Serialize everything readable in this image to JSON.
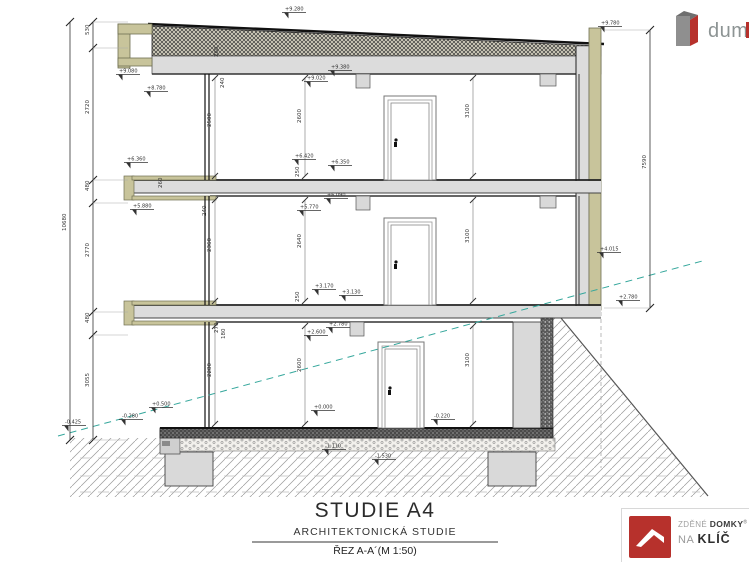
{
  "top_logo": {
    "text": "dum"
  },
  "title_block": {
    "title": "STUDIE A4",
    "subtitle": "ARCHITEKTONICKÁ STUDIE",
    "sheet": "ŘEZ A-A´(M 1:50)"
  },
  "brand": {
    "word1": "ZDĚNÉ",
    "word2": "DOMKY",
    "reg": "®",
    "word3": "NA",
    "word4": "KLÍČ"
  },
  "colors": {
    "olive_insulation": "#c8c49b",
    "slab_gray": "#dcdcdc",
    "terrain_teal": "#35a79c",
    "brand_red": "#b7312c",
    "dim_text": "#333333"
  },
  "drawing": {
    "dims": [
      {
        "t": "530",
        "x": 89,
        "y": 35,
        "r": true
      },
      {
        "t": "2720",
        "x": 89,
        "y": 114,
        "r": true
      },
      {
        "t": "480",
        "x": 89,
        "y": 191,
        "r": true
      },
      {
        "t": "2770",
        "x": 89,
        "y": 257,
        "r": true
      },
      {
        "t": "480",
        "x": 89,
        "y": 323,
        "r": true
      },
      {
        "t": "3055",
        "x": 89,
        "y": 387,
        "r": true
      },
      {
        "t": "10680",
        "x": 66,
        "y": 231,
        "r": true
      },
      {
        "t": "7590",
        "x": 646,
        "y": 169,
        "r": true
      },
      {
        "t": "2500",
        "x": 211,
        "y": 127,
        "r": true
      },
      {
        "t": "2600",
        "x": 301,
        "y": 123,
        "r": true
      },
      {
        "t": "3100",
        "x": 469,
        "y": 118,
        "r": true
      },
      {
        "t": "2360",
        "x": 211,
        "y": 252,
        "r": true
      },
      {
        "t": "2640",
        "x": 301,
        "y": 248,
        "r": true
      },
      {
        "t": "3100",
        "x": 469,
        "y": 243,
        "r": true
      },
      {
        "t": "2280",
        "x": 211,
        "y": 377,
        "r": true
      },
      {
        "t": "2600",
        "x": 301,
        "y": 372,
        "r": true
      },
      {
        "t": "3100",
        "x": 469,
        "y": 367,
        "r": true
      },
      {
        "t": "260",
        "x": 218,
        "y": 57,
        "r": true
      },
      {
        "t": "240",
        "x": 224,
        "y": 88,
        "r": true
      },
      {
        "t": "260",
        "x": 162,
        "y": 188,
        "r": true
      },
      {
        "t": "240",
        "x": 206,
        "y": 216,
        "r": true
      },
      {
        "t": "270",
        "x": 218,
        "y": 333,
        "r": true
      },
      {
        "t": "180",
        "x": 225,
        "y": 339,
        "r": true
      },
      {
        "t": "250",
        "x": 299,
        "y": 177,
        "r": true
      },
      {
        "t": "250",
        "x": 299,
        "y": 302,
        "r": true
      }
    ],
    "elevations": [
      {
        "t": "+9.280",
        "x": 284,
        "y": 10
      },
      {
        "t": "+9.780",
        "x": 600,
        "y": 24
      },
      {
        "t": "+9.080",
        "x": 118,
        "y": 72
      },
      {
        "t": "+8.780",
        "x": 146,
        "y": 89
      },
      {
        "t": "+9.380",
        "x": 330,
        "y": 68
      },
      {
        "t": "+9.020",
        "x": 306,
        "y": 79
      },
      {
        "t": "+6.360",
        "x": 126,
        "y": 160
      },
      {
        "t": "+5.880",
        "x": 132,
        "y": 207
      },
      {
        "t": "+6.420",
        "x": 294,
        "y": 157
      },
      {
        "t": "+6.350",
        "x": 330,
        "y": 163
      },
      {
        "t": "+6.090",
        "x": 326,
        "y": 196
      },
      {
        "t": "+5.770",
        "x": 299,
        "y": 208
      },
      {
        "t": "+3.170",
        "x": 314,
        "y": 287
      },
      {
        "t": "+3.130",
        "x": 341,
        "y": 293
      },
      {
        "t": "+2.780",
        "x": 328,
        "y": 325
      },
      {
        "t": "+2.600",
        "x": 306,
        "y": 333
      },
      {
        "t": "+0.000",
        "x": 313,
        "y": 408
      },
      {
        "t": "-0.220",
        "x": 433,
        "y": 417
      },
      {
        "t": "+0.500",
        "x": 151,
        "y": 405
      },
      {
        "t": "-0.280",
        "x": 121,
        "y": 417
      },
      {
        "t": "-0.425",
        "x": 64,
        "y": 423
      },
      {
        "t": "-1.110",
        "x": 324,
        "y": 447
      },
      {
        "t": "-1.530",
        "x": 374,
        "y": 457
      },
      {
        "t": "+4.015",
        "x": 599,
        "y": 250
      },
      {
        "t": "+2.780",
        "x": 618,
        "y": 298
      }
    ]
  }
}
